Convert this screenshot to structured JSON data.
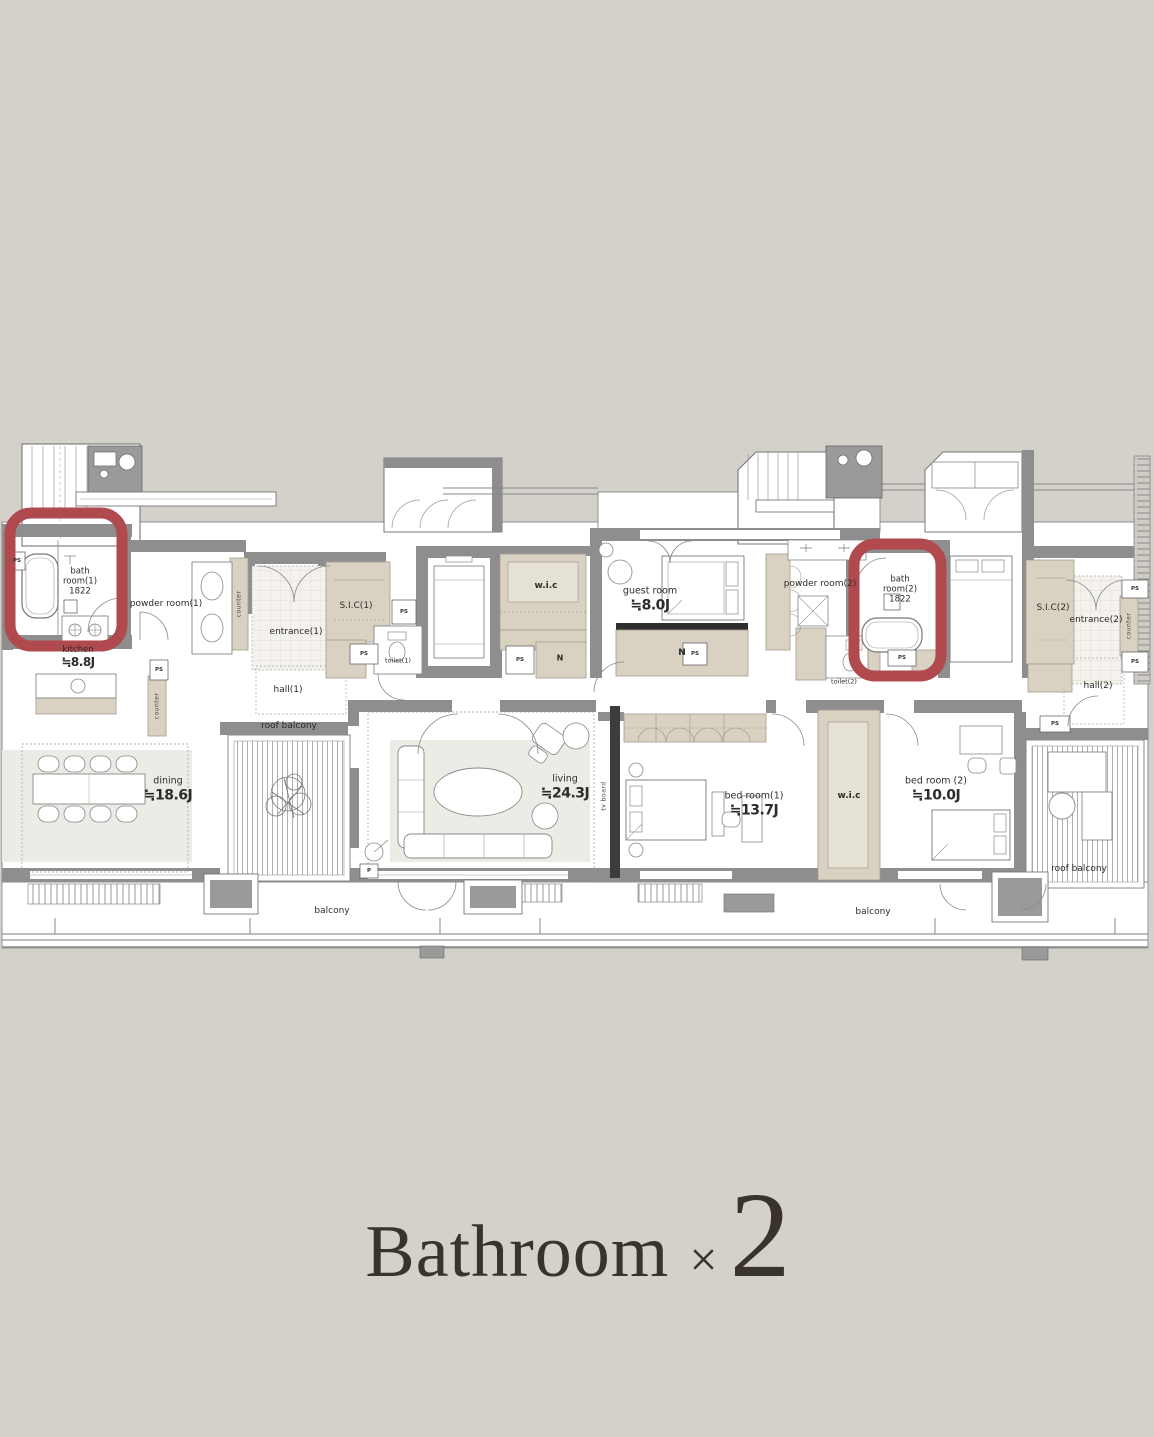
{
  "title": {
    "word": "Bathroom",
    "times": "×",
    "count": "2"
  },
  "colors": {
    "background": "#d3d1ca",
    "highlight": "#b04a4f",
    "wall": "#8e8e8e",
    "closet_beige": "#d9d2c2",
    "title_ink": "#3a322c"
  },
  "labels": {
    "bath1": {
      "name": "bath\nroom(1)",
      "dim": "1822"
    },
    "powder1": "powder room(1)",
    "kitchen": {
      "name": "kitchen",
      "size": "≒8.8J"
    },
    "entrance1": "entrance(1)",
    "sic1": "S.I.C(1)",
    "toilet1": "toilet(1)",
    "hall1": "hall(1)",
    "wic": "w.i.c",
    "n": "N",
    "guest": {
      "name": "guest room",
      "size": "≒8.0J"
    },
    "powder2": "powder room(2)",
    "toilet2": "toilet(2)",
    "bath2": {
      "name": "bath\nroom(2)",
      "dim": "1822"
    },
    "sic2": "S.I.C(2)",
    "entrance2": "entrance(2)",
    "hall2": "hall(2)",
    "dining": {
      "name": "dining",
      "size": "≒18.6J"
    },
    "living": {
      "name": "living",
      "size": "≒24.3J"
    },
    "bed1": {
      "name": "bed room(1)",
      "size": "≒13.7J"
    },
    "bed2": {
      "name": "bed room (2)",
      "size": "≒10.0J"
    },
    "roof_balcony": "roof balcony",
    "balcony": "balcony",
    "tv_board": "tv board",
    "counter": "counter",
    "ps": "PS",
    "p": "P"
  }
}
